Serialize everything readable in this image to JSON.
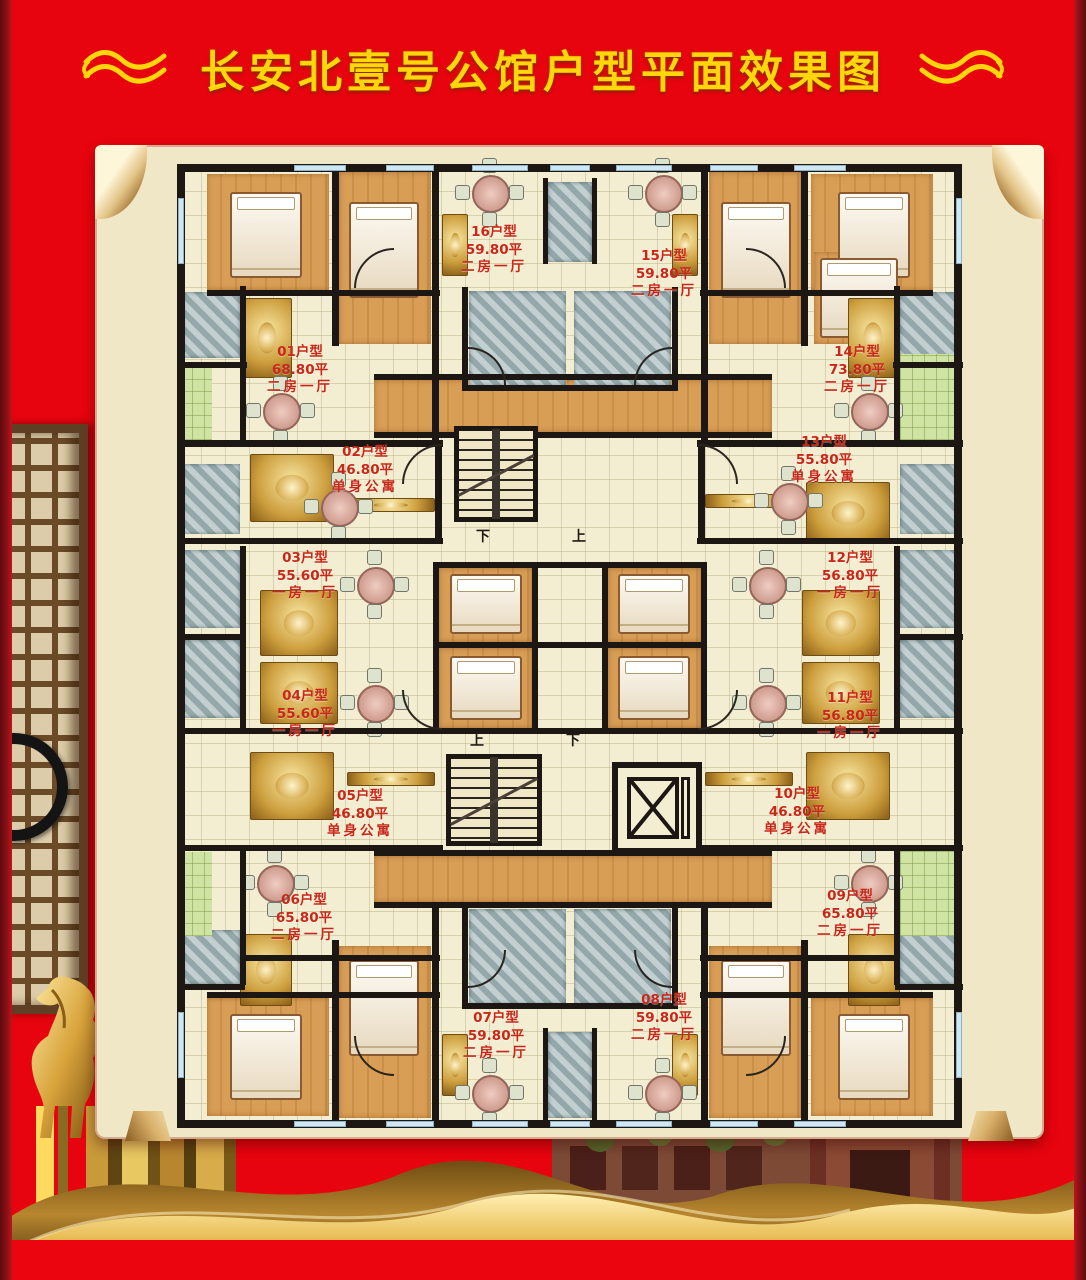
{
  "title": {
    "text": "长安北壹号公馆户型平面效果图",
    "color": "#ffd60a",
    "ornament_left": "swirl-flourish-icon",
    "ornament_right": "swirl-flourish-icon"
  },
  "palette": {
    "background_red": "#e8040e",
    "edge_maroon": "#7c1016",
    "parchment_beige": "#efe7c6",
    "wall_black": "#1c1713",
    "unit_label_red": "#c8281a",
    "gold_accent": "#e7b33c",
    "wood_floor": "#d99e56",
    "bath_tile": "#a8bcbf",
    "balcony_green": "#cfe3a2"
  },
  "plan": {
    "stairs": [
      {
        "name": "upper-stairwell",
        "label": "下　上"
      },
      {
        "name": "lower-stairwell",
        "label": "上　下"
      }
    ],
    "elevator": {
      "name": "elevator-shaft"
    },
    "units": [
      {
        "name": "01户型",
        "area": "68.80平",
        "layout": "二房一厅",
        "x": 298,
        "y": 342
      },
      {
        "name": "02户型",
        "area": "46.80平",
        "layout": "单身公寓",
        "x": 363,
        "y": 442
      },
      {
        "name": "03户型",
        "area": "55.60平",
        "layout": "一房一厅",
        "x": 303,
        "y": 548
      },
      {
        "name": "04户型",
        "area": "55.60平",
        "layout": "一房一厅",
        "x": 303,
        "y": 686
      },
      {
        "name": "05户型",
        "area": "46.80平",
        "layout": "单身公寓",
        "x": 358,
        "y": 786
      },
      {
        "name": "06户型",
        "area": "65.80平",
        "layout": "二房一厅",
        "x": 302,
        "y": 890
      },
      {
        "name": "07户型",
        "area": "59.80平",
        "layout": "二房一厅",
        "x": 494,
        "y": 1008
      },
      {
        "name": "08户型",
        "area": "59.80平",
        "layout": "二房一厅",
        "x": 662,
        "y": 990
      },
      {
        "name": "09户型",
        "area": "65.80平",
        "layout": "二房一厅",
        "x": 848,
        "y": 886
      },
      {
        "name": "10户型",
        "area": "46.80平",
        "layout": "单身公寓",
        "x": 795,
        "y": 784
      },
      {
        "name": "11户型",
        "area": "56.80平",
        "layout": "一房一厅",
        "x": 848,
        "y": 688
      },
      {
        "name": "12户型",
        "area": "56.80平",
        "layout": "一房一厅",
        "x": 848,
        "y": 548
      },
      {
        "name": "13户型",
        "area": "55.80平",
        "layout": "单身公寓",
        "x": 822,
        "y": 432
      },
      {
        "name": "14户型",
        "area": "73.80平",
        "layout": "二房一厅",
        "x": 855,
        "y": 342
      },
      {
        "name": "15户型",
        "area": "59.80平",
        "layout": "二房一厅",
        "x": 662,
        "y": 246
      },
      {
        "name": "16户型",
        "area": "59.80平",
        "layout": "二房一厅",
        "x": 492,
        "y": 222
      }
    ]
  }
}
